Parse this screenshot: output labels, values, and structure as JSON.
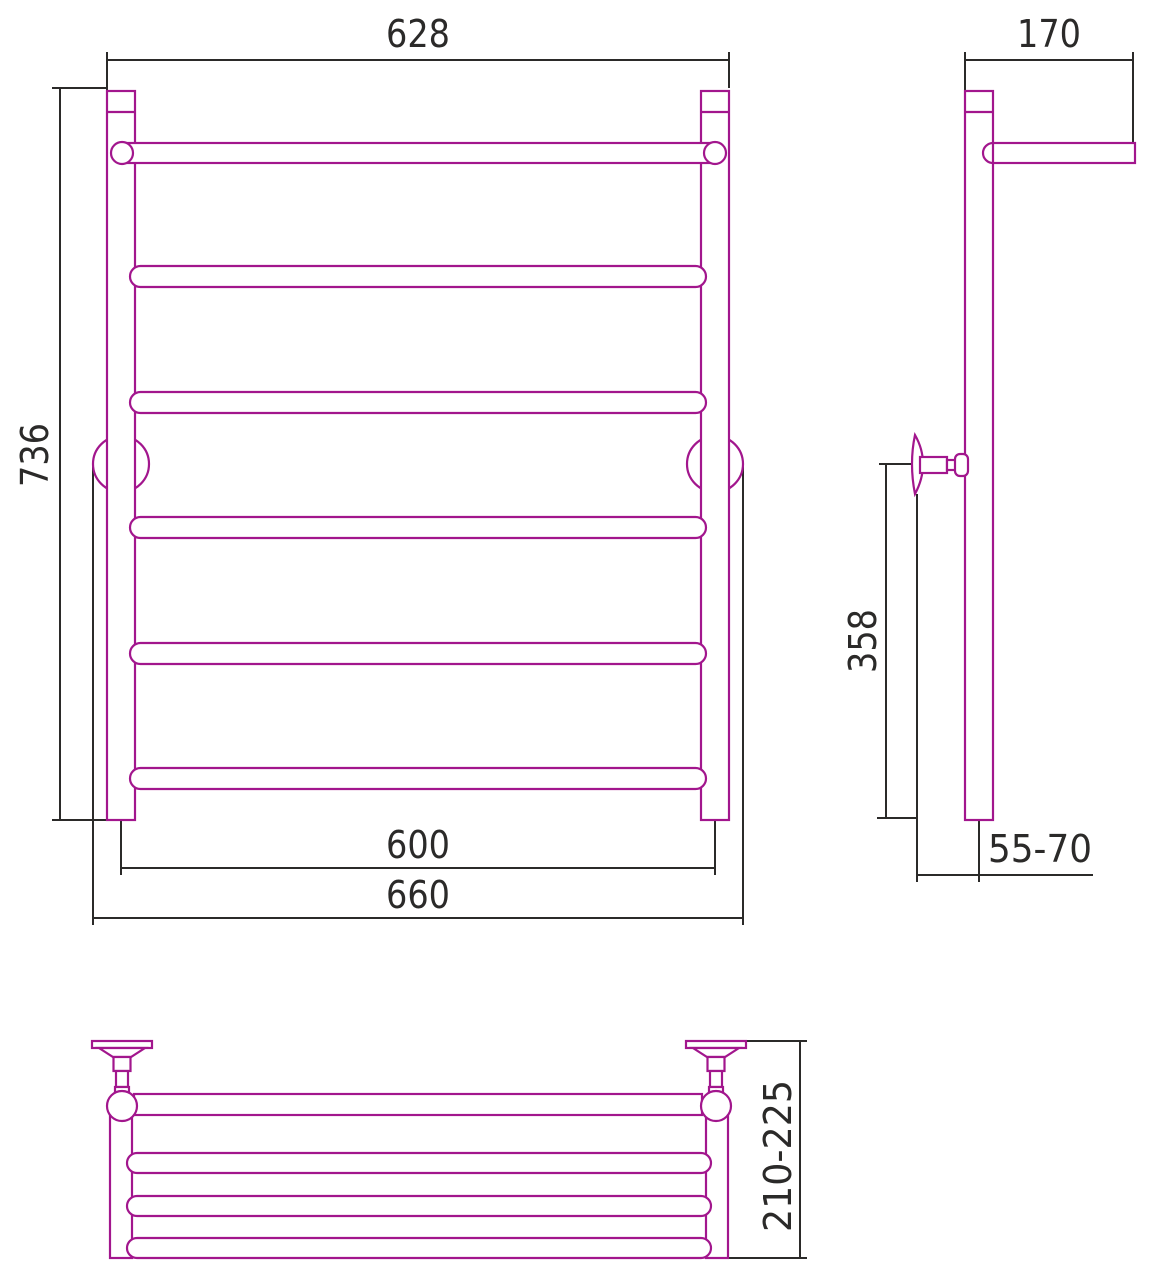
{
  "drawing": {
    "type": "technical-dimension-drawing",
    "subject": "ladder towel rail with shelf, three orthographic views",
    "units": "mm",
    "colors": {
      "product_outline": "#a2168d",
      "dimension_lines": "#2b2a29",
      "background": "#ffffff"
    },
    "views": {
      "front": {
        "label": "front-view",
        "rung_count": 6,
        "dimensions": {
          "top_width": "628",
          "overall_height": "736",
          "post_center_spacing": "600",
          "overall_width_brackets": "660"
        }
      },
      "side": {
        "label": "side-view",
        "dimensions": {
          "top_rail_depth": "170",
          "bracket_to_bottom_height": "358",
          "wall_to_post_offset": "55-70"
        }
      },
      "top": {
        "label": "top-view-shelf",
        "shelf_bar_count": 4,
        "dimensions": {
          "overall_depth": "210-225"
        }
      }
    }
  }
}
